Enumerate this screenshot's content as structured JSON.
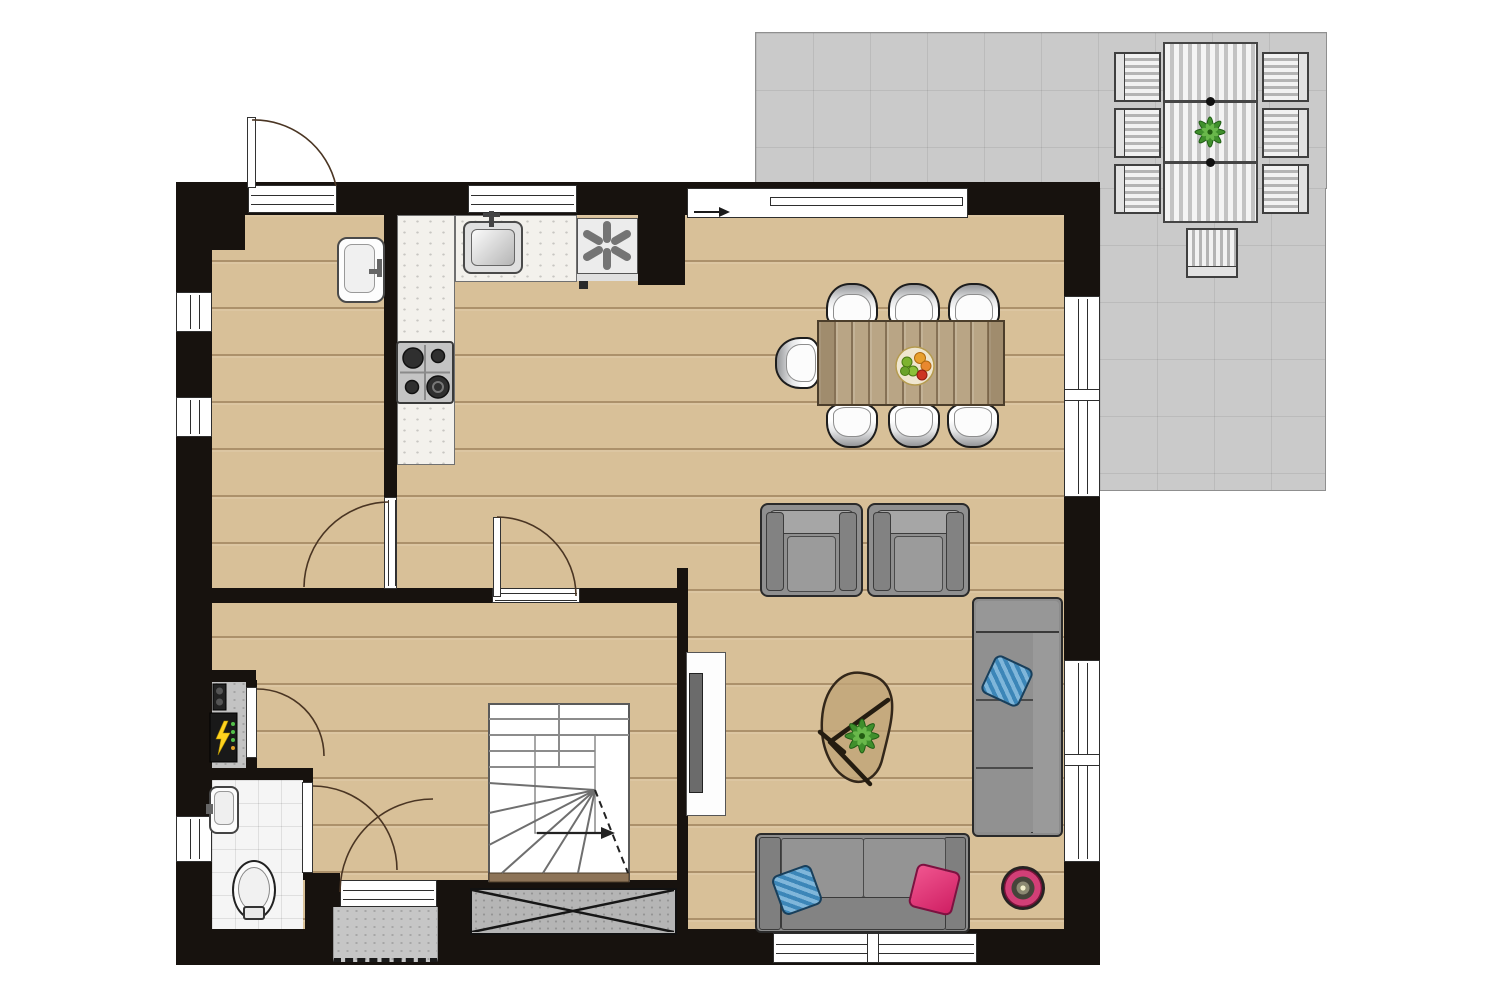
{
  "scene": {
    "type": "residential-floor-plan",
    "view": "top-down",
    "visible_text": "none"
  },
  "palette": {
    "wall": "#17120e",
    "wood_floor": "#d8c098",
    "wood_plank_line": "#765834",
    "terrace_tile": "#cacaca",
    "toilet_tile": "#f5f5f5",
    "counter": "#f3f1ec",
    "sofa_gray": "#8c8c8c",
    "pillow_blue": "#3c86b8",
    "pillow_pink": "#e0307a",
    "plant_green": "#3f8f2c",
    "side_table_pink": "#d23f77",
    "lightning_yellow": "#ffd21e",
    "stair_edge_brown": "#8d7458"
  },
  "rooms": [
    {
      "id": "utility-room",
      "features": [
        "wall-sink",
        "back-door",
        "two-left-windows",
        "door-to-hall"
      ]
    },
    {
      "id": "kitchen",
      "features": [
        "l-shaped-counter",
        "counter-sink",
        "gas-hob-4-burners",
        "ventilation-unit-asterisk",
        "top-window"
      ]
    },
    {
      "id": "dining-area",
      "features": [
        "wood-table",
        "seven-chairs",
        "fruit-bowl",
        "sliding-door-to-terrace",
        "right-window"
      ]
    },
    {
      "id": "living-area",
      "features": [
        "two-armchairs",
        "corner-sofa-blue-pillow",
        "two-seat-sofa-blue-and-pink-pillows",
        "organic-coffee-table-with-plant",
        "round-pink-side-table",
        "tv-cabinet",
        "right-window",
        "bottom-window"
      ]
    },
    {
      "id": "hall",
      "features": [
        "winder-staircase-with-arrow",
        "front-door",
        "porch-step",
        "crawl-space-hatch-x",
        "meter-cupboard-electrical-panel"
      ]
    },
    {
      "id": "toilet",
      "features": [
        "wc",
        "hand-basin",
        "left-window",
        "tiled-floor"
      ]
    },
    {
      "id": "terrace",
      "features": [
        "extendable-slat-table",
        "plant-on-table",
        "six-slat-chairs",
        "slat-bench",
        "tile-grid"
      ]
    }
  ],
  "counts": {
    "dining_chairs": 7,
    "terrace_chairs": 6,
    "armchairs": 2,
    "sofas": 2,
    "interior_door_arcs": 4,
    "exterior_door_arcs": 2,
    "windows": 8
  },
  "icons": [
    {
      "name": "ventilation-asterisk-icon",
      "glyph": "✳"
    },
    {
      "name": "electrical-lightning-icon",
      "glyph": "⚡"
    },
    {
      "name": "stair-direction-arrow",
      "glyph": "→"
    },
    {
      "name": "sliding-door-arrow",
      "glyph": "→"
    }
  ]
}
